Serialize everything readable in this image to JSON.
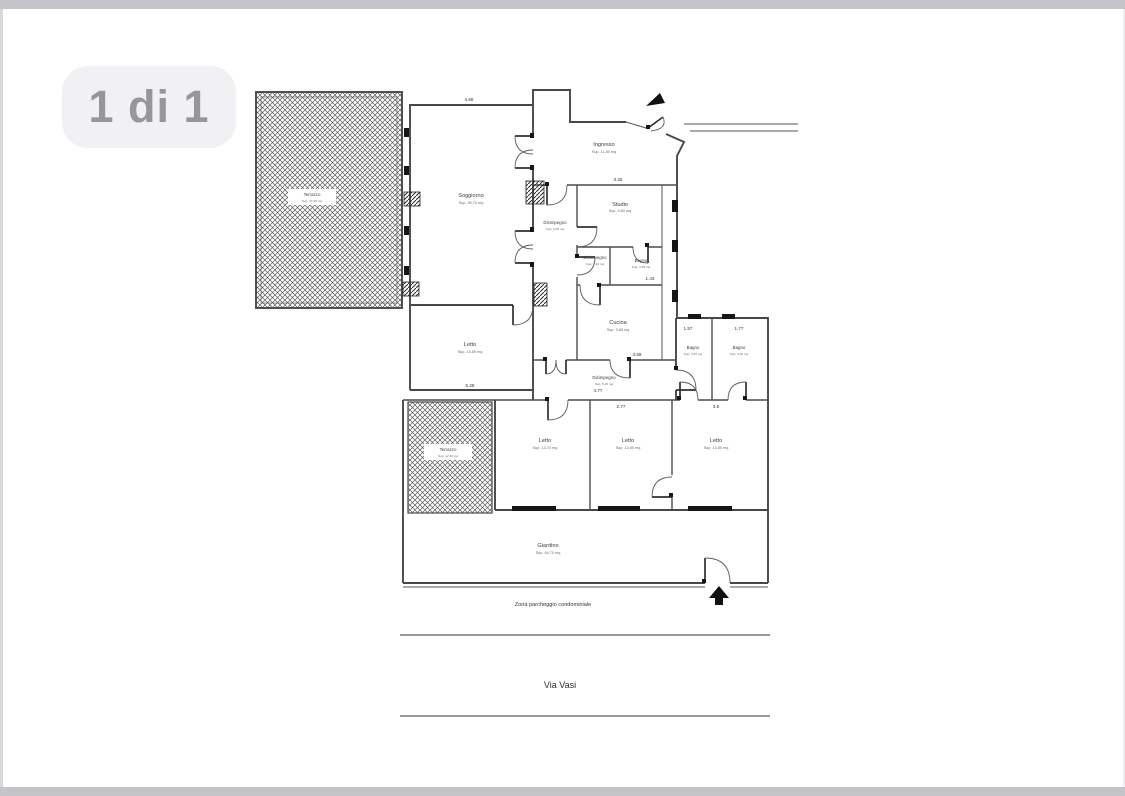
{
  "viewer": {
    "badge_label": "1 di 1"
  },
  "floorplan": {
    "rooms": [
      {
        "id": "terrazzo-1",
        "name": "Terrazzo",
        "area": "Sup. 37.90 mq"
      },
      {
        "id": "soggiorno",
        "name": "Soggiorno",
        "area": "Sup. 35.70 mq"
      },
      {
        "id": "ingresso",
        "name": "Ingresso",
        "area": "Sup. 11.80 mq"
      },
      {
        "id": "studio",
        "name": "Studio",
        "area": "Sup. 9.80 mq"
      },
      {
        "id": "disimpegno-1",
        "name": "Disimpegno",
        "area": "Sup. 3.05 mq"
      },
      {
        "id": "disimpegno-2",
        "name": "Disimpegno",
        "area": "Sup. 1.40 mq"
      },
      {
        "id": "bagno-1",
        "name": "Bagno",
        "area": "Sup. 4.95 mq"
      },
      {
        "id": "cucina",
        "name": "Cucina",
        "area": "Sup. 9.85 mq"
      },
      {
        "id": "letto-1",
        "name": "Letto",
        "area": "Sup. 15.80 mq"
      },
      {
        "id": "disimpegno-3",
        "name": "Disimpegno",
        "area": "Sup. 5.45 mq"
      },
      {
        "id": "bagno-2",
        "name": "Bagno",
        "area": "Sup. 3.45 mq"
      },
      {
        "id": "bagno-3",
        "name": "Bagno",
        "area": "Sup. 4.20 mq"
      },
      {
        "id": "terrazzo-2",
        "name": "Terrazzo",
        "area": "Sup. 12.30 mq"
      },
      {
        "id": "letto-2",
        "name": "Letto",
        "area": "Sup. 13.70 mq"
      },
      {
        "id": "letto-3",
        "name": "Letto",
        "area": "Sup. 12.60 mq"
      },
      {
        "id": "letto-4",
        "name": "Letto",
        "area": "Sup. 13.80 mq"
      },
      {
        "id": "giardino",
        "name": "Giardino",
        "area": "Sup. 64.70 mq"
      }
    ],
    "dimensions": [
      "4.68",
      "3.25",
      "1.57",
      "1.77",
      "3.58",
      "4.77",
      "2.77",
      "3.5",
      "5.28",
      "1.43"
    ],
    "captions": {
      "parking_zone": "Zona parcheggio condominiale",
      "street_name": "Via Vasi"
    },
    "colors": {
      "wall": "#474747",
      "frame": "#c4c4c9",
      "badge_bg": "#f1f1f3",
      "badge_text": "#97979b"
    }
  }
}
